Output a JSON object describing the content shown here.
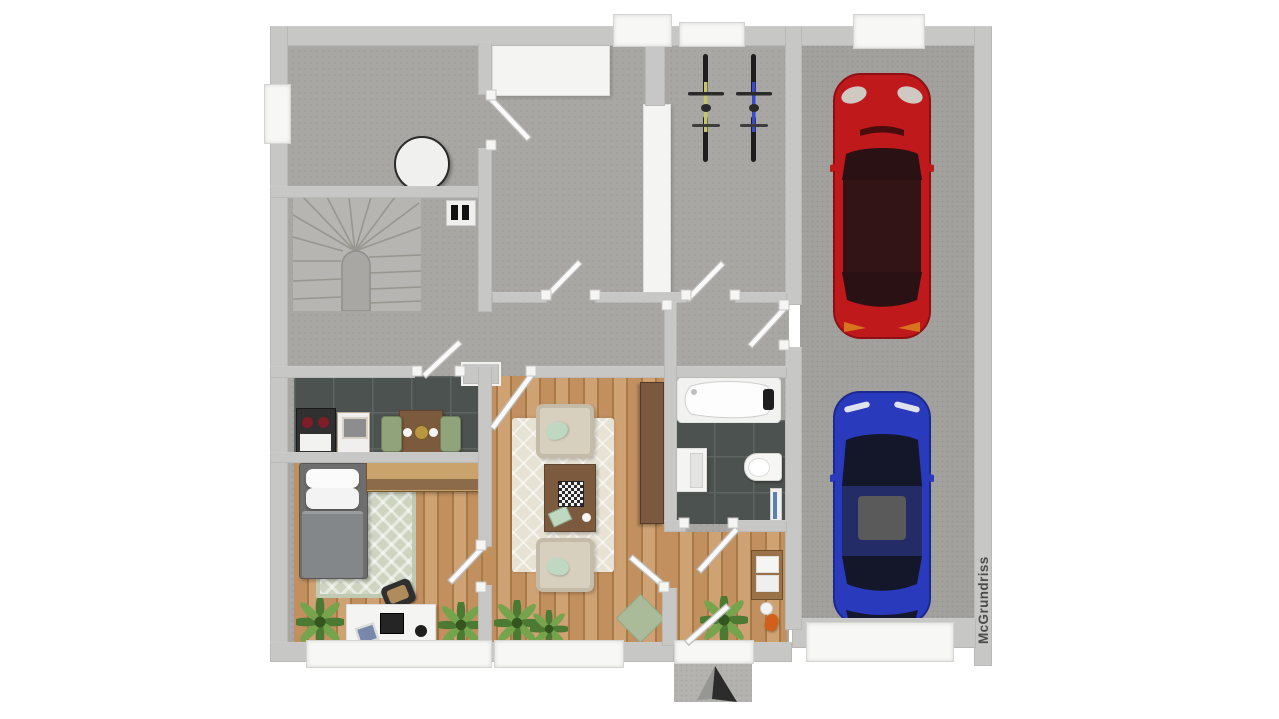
{
  "watermark": {
    "text": "McGrundriss"
  },
  "plan": {
    "description": "3D top-down rendered floor plan: ground floor of a house with attached garage",
    "rooms": [
      {
        "name": "room-top-left",
        "floor": "concrete",
        "objects": [
          "wardrobe-white",
          "round-table",
          "left-window"
        ]
      },
      {
        "name": "staircase-area",
        "floor": "concrete",
        "objects": [
          "winder-stairs",
          "floor-vent"
        ]
      },
      {
        "name": "hallway",
        "floor": "concrete",
        "objects": []
      },
      {
        "name": "storage-room",
        "floor": "concrete",
        "objects": [
          "bicycle-yellow",
          "bicycle-blue",
          "white-cabinet"
        ]
      },
      {
        "name": "kitchen",
        "floor": "dark-tile",
        "objects": [
          "stove",
          "dishwasher",
          "dining-table",
          "green-chair-left",
          "green-chair-right",
          "plates",
          "centerpiece"
        ]
      },
      {
        "name": "bedroom",
        "floor": "wood",
        "objects": [
          "bed",
          "pillows",
          "gray-blanket",
          "dresser",
          "patterned-rug",
          "desk",
          "laptop",
          "desk-chair",
          "plant",
          "plant"
        ]
      },
      {
        "name": "living-room",
        "floor": "wood",
        "objects": [
          "armchair-top",
          "armchair-bottom",
          "coffee-table",
          "chess-board",
          "cream-rug",
          "sideboard",
          "plant",
          "plant",
          "green-doormat"
        ]
      },
      {
        "name": "bathroom",
        "floor": "dark-tile",
        "objects": [
          "bathtub",
          "vanity-cabinet",
          "toilet",
          "towel-rail"
        ]
      },
      {
        "name": "entry-hall",
        "floor": "wood",
        "objects": [
          "towel-shelf",
          "orange-object",
          "entry-door",
          "porch",
          "north-arrow"
        ]
      },
      {
        "name": "garage",
        "floor": "concrete",
        "objects": [
          "red-car",
          "blue-car",
          "garage-door"
        ]
      }
    ],
    "cars": [
      {
        "name": "red-car",
        "hex": "#c0191c",
        "orientation": "front-up"
      },
      {
        "name": "blue-car",
        "hex": "#2a3abc",
        "orientation": "front-up"
      }
    ],
    "bicycles": [
      {
        "name": "bicycle-yellow",
        "frame_hex": "#c5c56a"
      },
      {
        "name": "bicycle-blue",
        "frame_hex": "#3a4ad0"
      }
    ]
  },
  "colors": {
    "wall": "#c7c7c6",
    "window": "#f7f7f6",
    "concrete": "#a8a7a3",
    "garage_floor": "#a2a19d",
    "porch": "#b4b3b0",
    "wood": "#c2905f",
    "wood_light": "#cfa273",
    "wood_dark": "#a87a48",
    "tile": "#4c524f",
    "tile_line": "#5e6461",
    "rug_bedroom": "#cdd4c0",
    "rug_living": "#e7e2d4",
    "sofa": "#d7d0bf",
    "sofa_edge": "#c4bca8",
    "table_brown": "#7c5a3e",
    "dresser_front": "#8b6b4a",
    "dresser_top": "#c9a36b",
    "chair_green": "#90a37a",
    "mint": "#bfd8c2",
    "bed_blanket": "#84878a",
    "bed_frame": "#6e6e6e",
    "plant_dark": "#4c7a33",
    "plant_light": "#76a44c",
    "car_red": "#c0191c",
    "car_red_dark": "#8e1013",
    "car_blue": "#2a3abc",
    "car_blue_dark": "#1c2a8e",
    "glass_red_car": "#2a1214",
    "glass_blue_car": "#14162a",
    "bike_yellow": "#c5c56a",
    "bike_blue": "#3a4ad0",
    "orange": "#d2601a",
    "watermark": "#4b4b4b",
    "arrow": "#2c2c2c",
    "white_obj": "#f4f4f3",
    "stair": "#b6b5b1",
    "stair_line": "#97968f"
  }
}
